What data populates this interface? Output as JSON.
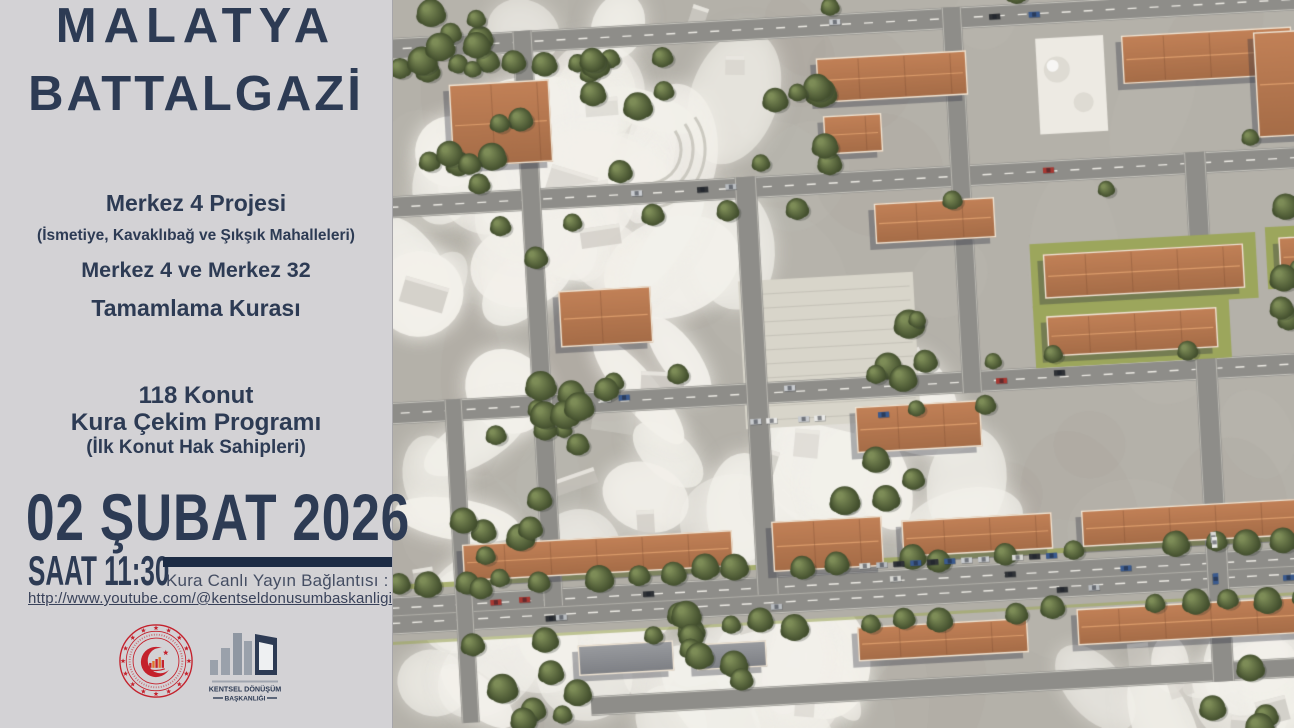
{
  "poster": {
    "title1": "MALATYA",
    "title2": "BATTALGAZİ",
    "project_line1": "Merkez 4 Projesi",
    "project_line2": "(İsmetiye, Kavaklıbağ ve Şıkşık Mahalleleri)",
    "project_line3": "Merkez 4 ve Merkez 32",
    "project_line4": "Tamamlama Kurası",
    "program_line1": "118 Konut",
    "program_line2": "Kura Çekim Programı",
    "program_line3": "(İlk Konut Hak Sahipleri)",
    "date": "02 ŞUBAT 2026",
    "time": "SAAT 11:30",
    "stream_label": "Kura Canlı Yayın Bağlantısı :",
    "stream_url": "http://www.youtube.com/@kentseldonusumbaskanligi",
    "agency_name_line1": "KENTSEL DÖNÜŞÜM",
    "agency_name_line2": "BAŞKANLIĞI",
    "colors": {
      "panel_bg": "#d3d2d5",
      "navy": "#2d3b54",
      "bar_navy": "#1c2b44",
      "seal_red": "#c4212c"
    }
  },
  "aerial": {
    "palette": {
      "base": "#b4b1a9",
      "white": "#f0eee8",
      "road": "#8e8d89",
      "lane": "#eceae4",
      "roof_light": "#c28157",
      "roof_dark": "#a56c47",
      "roof_edge": "#eee3d3",
      "grass": "#9ca65c",
      "tree_light": "#7d8c57",
      "tree_dark": "#434f2e",
      "plaza": "#d8d5ca",
      "mosque": "#edeae3",
      "cars": [
        "#e9e9e7",
        "#c9ccd0",
        "#a83832",
        "#3a5a8e",
        "#2f3236",
        "#b8bcc0",
        "#d8d8d4"
      ]
    }
  }
}
